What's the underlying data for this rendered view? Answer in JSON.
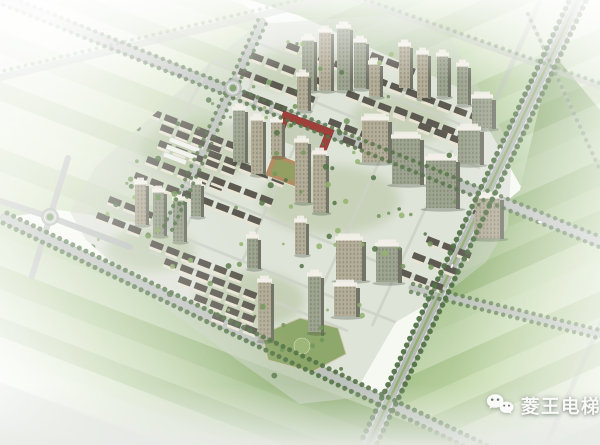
{
  "watermark": {
    "icon": "wechat-icon",
    "text": "菱王电梯"
  },
  "scene": {
    "type": "aerial architectural rendering",
    "subject": "residential community master plan, bird's-eye view",
    "features": [
      "striped farmland fading to white haze",
      "tree-lined boulevard with green median",
      "roundabout intersections",
      "rows of low-rise housing with dark roofs",
      "clusters of high-rise towers with white rooftop caps",
      "school with red courtyard building",
      "brown sports ground",
      "commercial podium with roof garden"
    ]
  },
  "palette": {
    "page_bg": "#f6f9f2",
    "field_light": "#eff4e7",
    "field_mid": "#cfe0ba",
    "field_dark": "#92b579",
    "road": "#bcc1bb",
    "road_casing": "#a2a8a2",
    "median_green": "#8fac6d",
    "tree_dark": "#4e6f41",
    "tree_mid": "#6f9355",
    "tree_light": "#8fb06a",
    "roof_dark": "#57544b",
    "facade_light": "#e9e3d2",
    "tower_facade_a": "#b2ab95",
    "tower_facade_b": "#9ba28c",
    "tower_side": "#6e6f62",
    "tower_cap": "#f1efe6",
    "school_red": "#9c3a32",
    "sports_ground": "#b08a5f",
    "podium_roof": "#86a15e",
    "site_base": "#cbd1c2",
    "haze": "#ffffff",
    "watermark_color": "#ffffff"
  }
}
